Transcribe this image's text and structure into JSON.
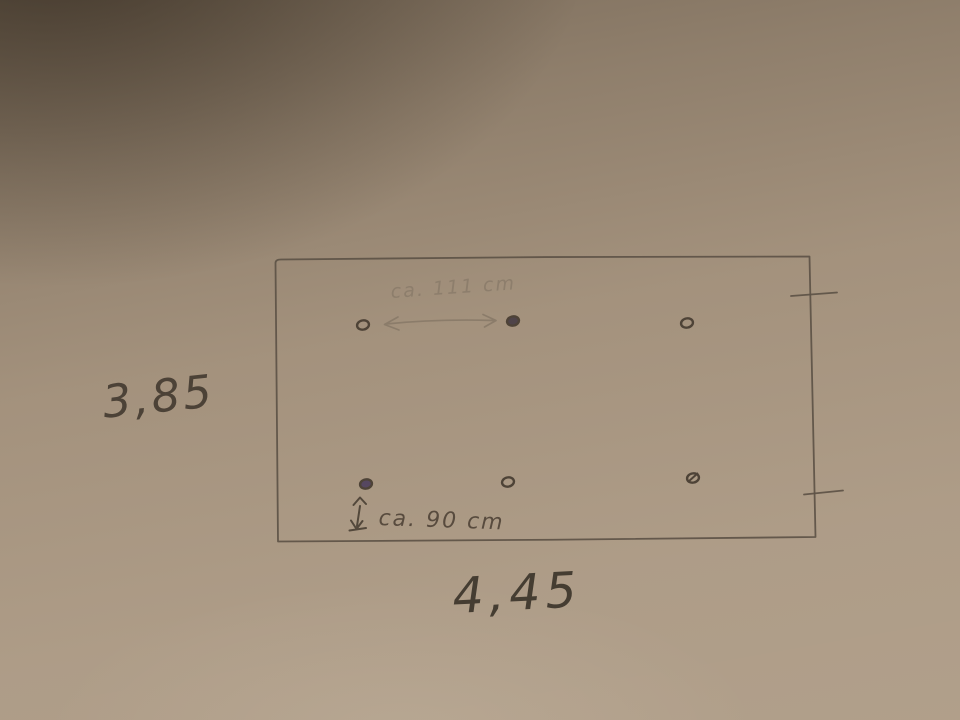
{
  "scene": {
    "kind": "photograph of hand-drawn pencil sketch on beige paper",
    "labels": {
      "height": "3,85",
      "width": "4,45",
      "top_span": "ca. 111 cm",
      "bottom_offset": "ca. 90 cm"
    },
    "colors": {
      "paper": "#a6947f",
      "paper_shadow": "#4a3e30",
      "paper_highlight": "#b3a28d",
      "pencil": "#5d5246",
      "pencil_dark": "#4e4337",
      "pencil_light": "#8a7b69",
      "ink_fill": "#4f4449",
      "ink_fill_tinted": "#564760"
    },
    "hole_markers": {
      "top_row": [
        {
          "x": 363,
          "y": 325,
          "style": "open"
        },
        {
          "x": 513,
          "y": 321,
          "style": "filled"
        },
        {
          "x": 687,
          "y": 323,
          "style": "open"
        }
      ],
      "bottom_row": [
        {
          "x": 366,
          "y": 484,
          "style": "filled",
          "tint": "#564760"
        },
        {
          "x": 508,
          "y": 482,
          "style": "open"
        },
        {
          "x": 693,
          "y": 478,
          "style": "slashed"
        }
      ]
    }
  }
}
